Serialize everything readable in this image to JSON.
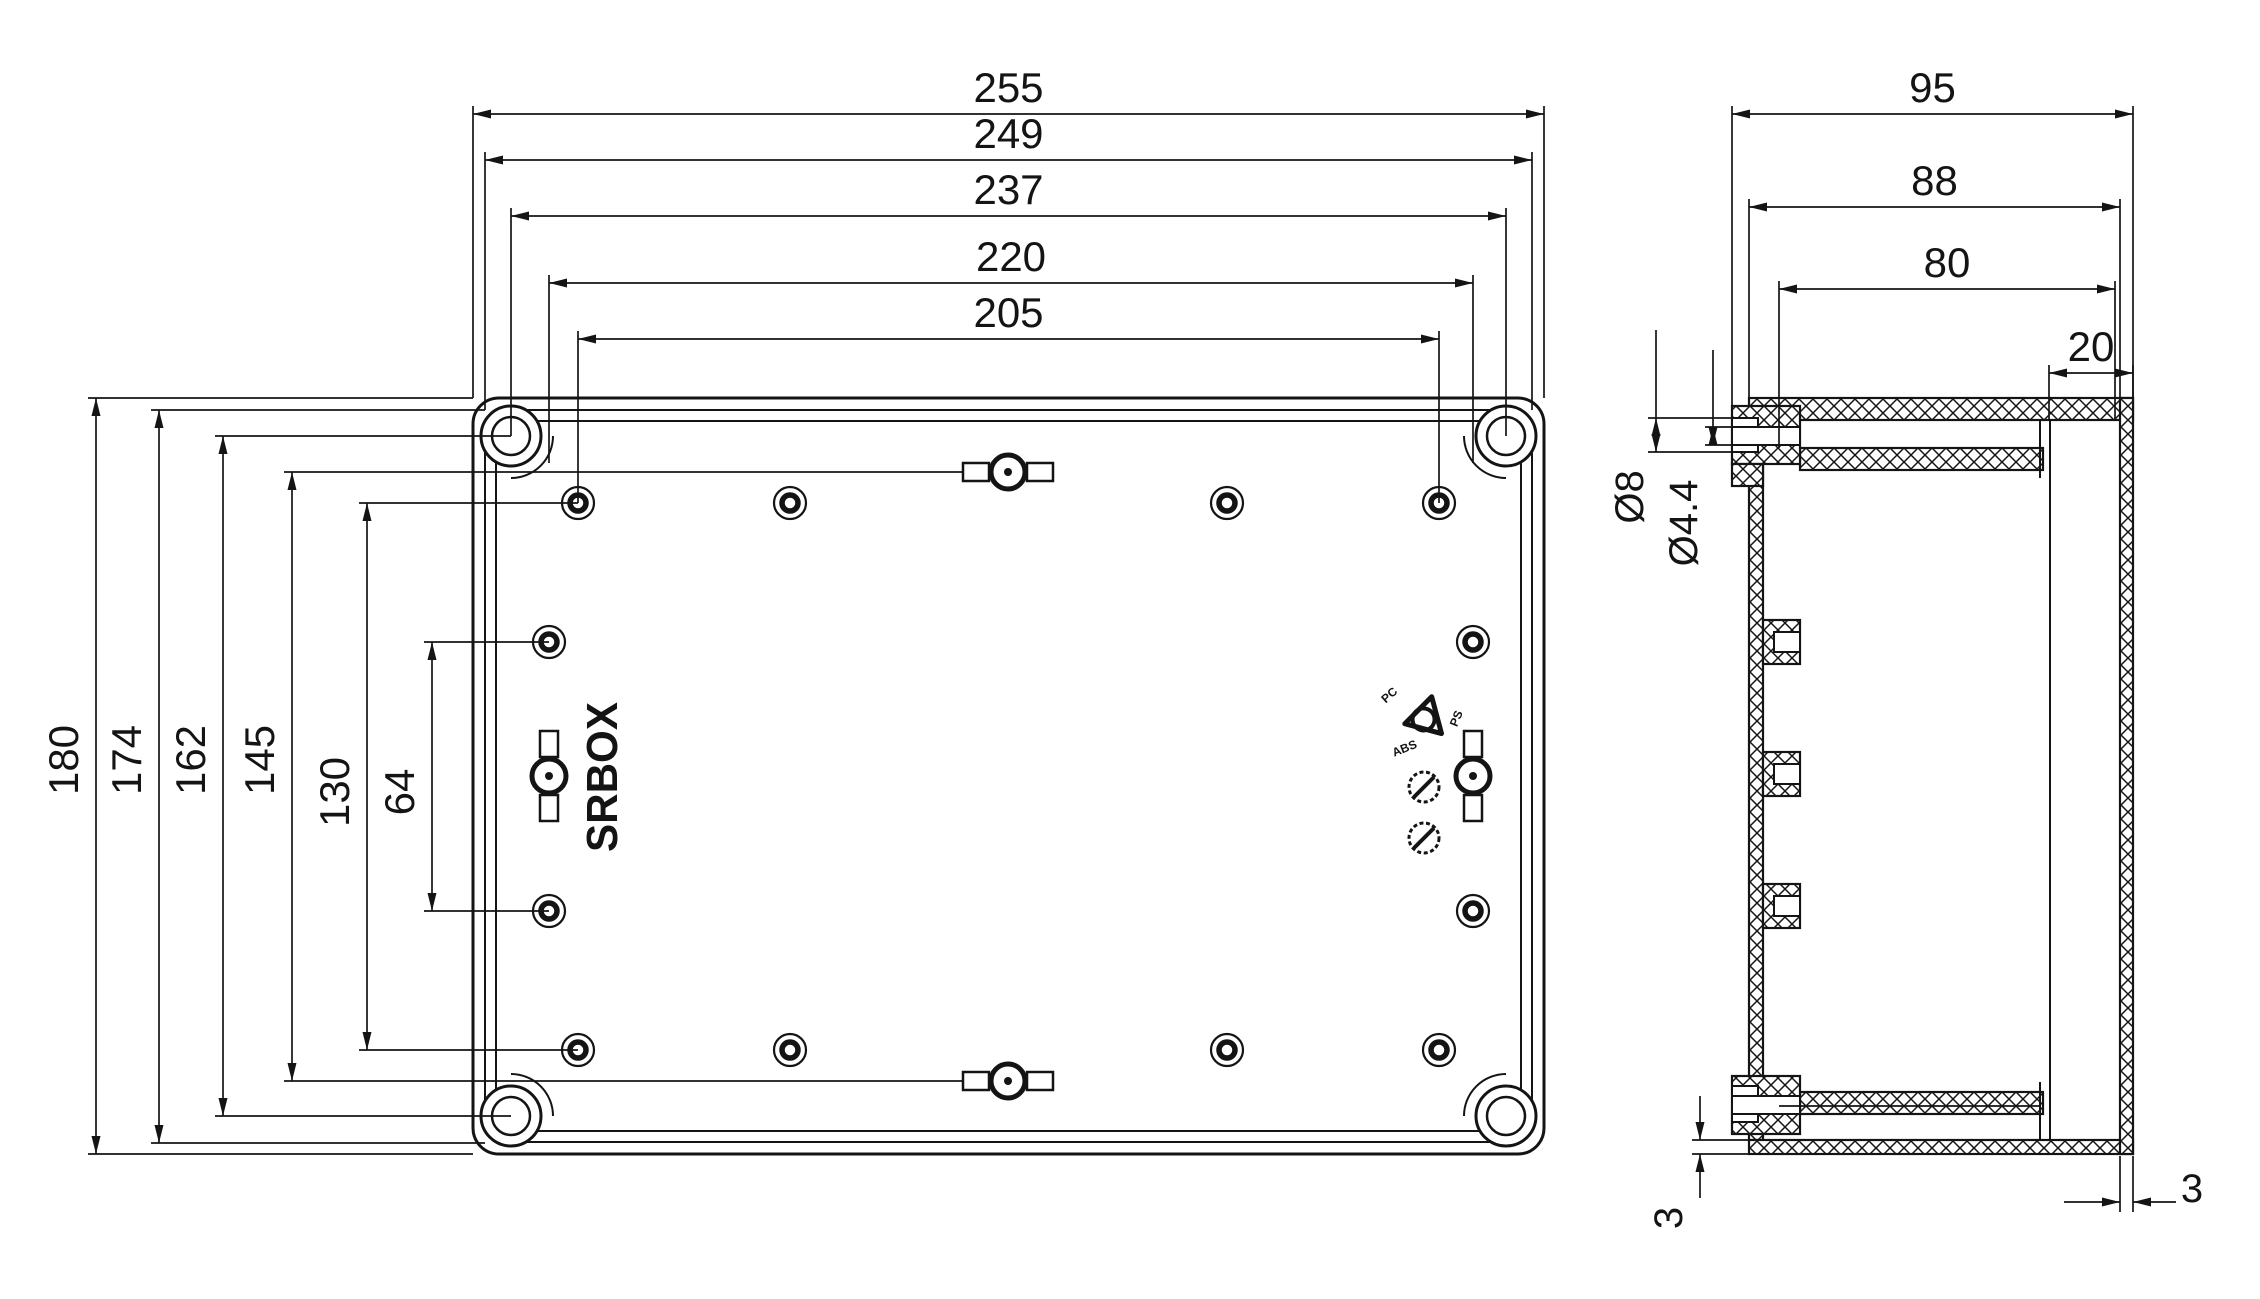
{
  "meta": {
    "ink": "#141414",
    "background": "#ffffff"
  },
  "logo": {
    "text": "SRBOX",
    "x": 617,
    "y": 777,
    "size": 44,
    "length": 150
  },
  "material_marks": {
    "center": [
      1426,
      718
    ],
    "labels": [
      {
        "text": "PC",
        "x": -34,
        "y": -20,
        "rot": -42,
        "size": 12
      },
      {
        "text": "PS",
        "x": 34,
        "y": 2,
        "rot": -68,
        "size": 12
      },
      {
        "text": "ABS",
        "x": -20,
        "y": 34,
        "rot": -22,
        "size": 12
      }
    ],
    "wheels": [
      [
        1424,
        787
      ],
      [
        1424,
        838
      ]
    ]
  },
  "front_view": {
    "outline_rects": [
      [
        473,
        398,
        1071,
        756,
        26,
        3
      ],
      [
        485,
        410,
        1047,
        732,
        18,
        2
      ],
      [
        496,
        421,
        1025,
        710,
        12,
        2
      ]
    ],
    "corner_screws": {
      "centers": [
        [
          511,
          436
        ],
        [
          1506,
          436
        ],
        [
          511,
          1116
        ],
        [
          1506,
          1116
        ]
      ],
      "r_outer": 30,
      "r_inner": 19,
      "boss_r": 42,
      "boss_arcs": [
        "M 553 436 A 42 42 0 0 1 511 478",
        "M 1506 478 A 42 42 0 0 1 1464 436",
        "M 511 1074 A 42 42 0 0 1 553 1116",
        "M 1464 1116 A 42 42 0 0 1 1506 1074"
      ]
    },
    "mounting_holes": [
      [
        578,
        503
      ],
      [
        790,
        503
      ],
      [
        1227,
        503
      ],
      [
        1439,
        503
      ],
      [
        578,
        1050
      ],
      [
        790,
        1050
      ],
      [
        1227,
        1050
      ],
      [
        1439,
        1050
      ],
      [
        549,
        642
      ],
      [
        549,
        911
      ],
      [
        1473,
        642
      ],
      [
        1473,
        911
      ]
    ],
    "clips": [
      {
        "cx": 1008,
        "cy": 472,
        "orient": "h"
      },
      {
        "cx": 1008,
        "cy": 1081,
        "orient": "h"
      },
      {
        "cx": 549,
        "cy": 776,
        "orient": "v"
      },
      {
        "cx": 1473,
        "cy": 776,
        "orv": true,
        "orient": "v"
      }
    ],
    "dims_top": [
      {
        "label": "255",
        "y": 114,
        "x1": 473,
        "x2": 1544,
        "drop1": 398,
        "drop2": 398
      },
      {
        "label": "249",
        "y": 160,
        "x1": 485,
        "x2": 1532,
        "drop1": 410,
        "drop2": 410
      },
      {
        "label": "237",
        "y": 216,
        "x1": 511,
        "x2": 1506,
        "drop1": 436,
        "drop2": 436
      },
      {
        "label": "220",
        "y": 283,
        "x1": 549,
        "x2": 1473,
        "drop1": 463,
        "drop2": 463
      },
      {
        "label": "205",
        "y": 339,
        "x1": 578,
        "x2": 1439,
        "drop1": 503,
        "drop2": 503
      }
    ],
    "dims_left": [
      {
        "label": "180",
        "x": 96,
        "y1": 398,
        "y2": 1154,
        "ext": 473,
        "ly": 760
      },
      {
        "label": "174",
        "x": 159,
        "y1": 410,
        "y2": 1143,
        "ext": 485,
        "ly": 760
      },
      {
        "label": "162",
        "x": 223,
        "y1": 436,
        "y2": 1116,
        "ext": 511,
        "ly": 760
      },
      {
        "label": "145",
        "x": 292,
        "y1": 472,
        "y2": 1081,
        "ext": 963,
        "ly": 760
      },
      {
        "label": "130",
        "x": 367,
        "y1": 503,
        "y2": 1050,
        "ext": 578,
        "ly": 792
      },
      {
        "label": "64",
        "x": 432,
        "y1": 642,
        "y2": 911,
        "ext": 549,
        "ly": 792
      }
    ]
  },
  "side_view": {
    "hatched_rects": [
      [
        1749,
        398,
        384,
        22
      ],
      [
        1800,
        448,
        243,
        22
      ],
      [
        1749,
        420,
        14,
        720
      ],
      [
        1749,
        1140,
        384,
        14
      ],
      [
        1800,
        1092,
        243,
        22
      ],
      [
        2120,
        398,
        13,
        756
      ],
      [
        1732,
        406,
        68,
        58
      ],
      [
        1732,
        464,
        31,
        22
      ],
      [
        1732,
        1076,
        68,
        58
      ],
      [
        1763,
        620,
        37,
        44
      ],
      [
        1763,
        752,
        37,
        44
      ],
      [
        1763,
        884,
        37,
        44
      ]
    ],
    "white_rects": [
      [
        1732,
        418,
        26,
        34
      ],
      [
        1732,
        427,
        68,
        18
      ],
      [
        1774,
        632,
        26,
        20
      ],
      [
        1774,
        764,
        26,
        20
      ],
      [
        1774,
        896,
        26,
        20
      ],
      [
        1732,
        1086,
        26,
        36
      ],
      [
        1732,
        1096,
        68,
        18
      ]
    ],
    "plain_lines": [
      [
        2050,
        420,
        2050,
        1140,
        2
      ],
      [
        2040,
        420,
        2040,
        478,
        2
      ],
      [
        2040,
        1082,
        2040,
        1140,
        2
      ],
      [
        1779,
        1106,
        2040,
        1106,
        1.7
      ]
    ],
    "dims_top": [
      {
        "label": "95",
        "y": 114,
        "x1": 1732,
        "x2": 2133,
        "drop1": 406,
        "drop2": 398
      },
      {
        "label": "88",
        "y": 207,
        "x1": 1749,
        "x2": 2120,
        "drop1": 406,
        "drop2": 398
      },
      {
        "label": "80",
        "y": 289,
        "x1": 1779,
        "x2": 2115,
        "drop1": 448,
        "drop2": 420
      },
      {
        "label": "20",
        "y": 373,
        "x1": 2049,
        "x2": 2133,
        "drop1": 420,
        "drop2": 398
      }
    ],
    "custom_dims": [
      {
        "name": "dim-dia-8",
        "lines": [
          [
            1648,
            418,
            1734,
            418
          ],
          [
            1648,
            452,
            1734,
            452
          ],
          [
            1656,
            330,
            1656,
            452
          ]
        ],
        "arrows": [
          {
            "x": 1656,
            "y": 418,
            "dir": -90
          },
          {
            "x": 1656,
            "y": 452,
            "dir": 90
          }
        ],
        "texts": [
          {
            "s": "Ø8",
            "x": 1643,
            "y": 497,
            "rot": -90,
            "size": 40
          }
        ]
      },
      {
        "name": "dim-dia-4-4",
        "lines": [
          [
            1705,
            427,
            1734,
            427
          ],
          [
            1705,
            445,
            1734,
            445
          ],
          [
            1713,
            350,
            1713,
            445
          ]
        ],
        "arrows": [
          {
            "x": 1713,
            "y": 427,
            "dir": -90
          },
          {
            "x": 1713,
            "y": 445,
            "dir": 90
          }
        ],
        "texts": [
          {
            "s": "Ø4.4",
            "x": 1697,
            "y": 523,
            "rot": -90,
            "size": 40
          }
        ]
      },
      {
        "name": "dim-bottom-thickness",
        "lines": [
          [
            1692,
            1140,
            1749,
            1140
          ],
          [
            1692,
            1154,
            1749,
            1154
          ],
          [
            1700,
            1096,
            1700,
            1140
          ],
          [
            1700,
            1154,
            1700,
            1198
          ]
        ],
        "arrows": [
          {
            "x": 1700,
            "y": 1140,
            "dir": 90
          },
          {
            "x": 1700,
            "y": 1154,
            "dir": -90
          }
        ],
        "texts": [
          {
            "s": "3",
            "x": 1682,
            "y": 1218,
            "rot": -90,
            "size": 40
          }
        ]
      },
      {
        "name": "dim-cover-thickness",
        "lines": [
          [
            2120,
            1156,
            2120,
            1212
          ],
          [
            2133,
            1156,
            2133,
            1212
          ],
          [
            2064,
            1202,
            2120,
            1202
          ],
          [
            2133,
            1202,
            2176,
            1202
          ]
        ],
        "arrows": [
          {
            "x": 2120,
            "y": 1202,
            "dir": 0
          },
          {
            "x": 2133,
            "y": 1202,
            "dir": 180
          }
        ],
        "texts": [
          {
            "s": "3",
            "x": 2192,
            "y": 1202,
            "rot": 0,
            "size": 40
          }
        ]
      }
    ]
  }
}
